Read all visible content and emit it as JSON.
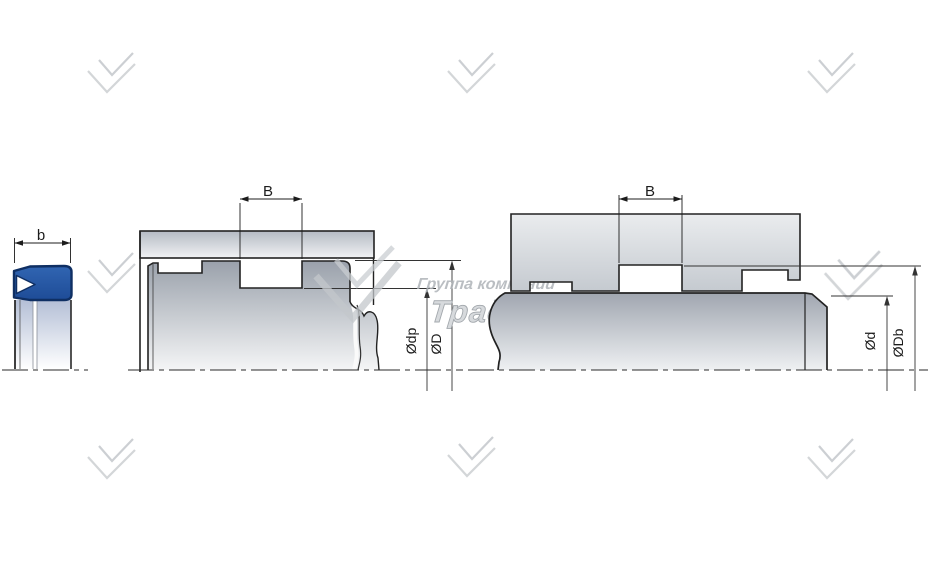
{
  "drawing": {
    "title": "seal-groove-installation-drawing",
    "figures": {
      "seal_profile": {
        "name": "seal cross-section",
        "labels": {
          "width": "b"
        }
      },
      "piston_groove": {
        "name": "piston seal groove installation",
        "labels": {
          "groove_width": "B",
          "groove_diameter": "Ødp",
          "bore_diameter": "ØD"
        }
      },
      "rod_groove": {
        "name": "rod seal groove installation",
        "labels": {
          "groove_width": "B",
          "rod_diameter": "Ød",
          "groove_diameter": "ØDb"
        }
      }
    }
  },
  "watermark": {
    "company_line1": "Группа компаний",
    "company_line2": "Традиция"
  },
  "colors": {
    "background": "#ffffff",
    "line": "#222222",
    "seal_fill": "#2b5fac",
    "seal_outline": "#0f2f63",
    "watermark_gray": "#c9cccf"
  }
}
